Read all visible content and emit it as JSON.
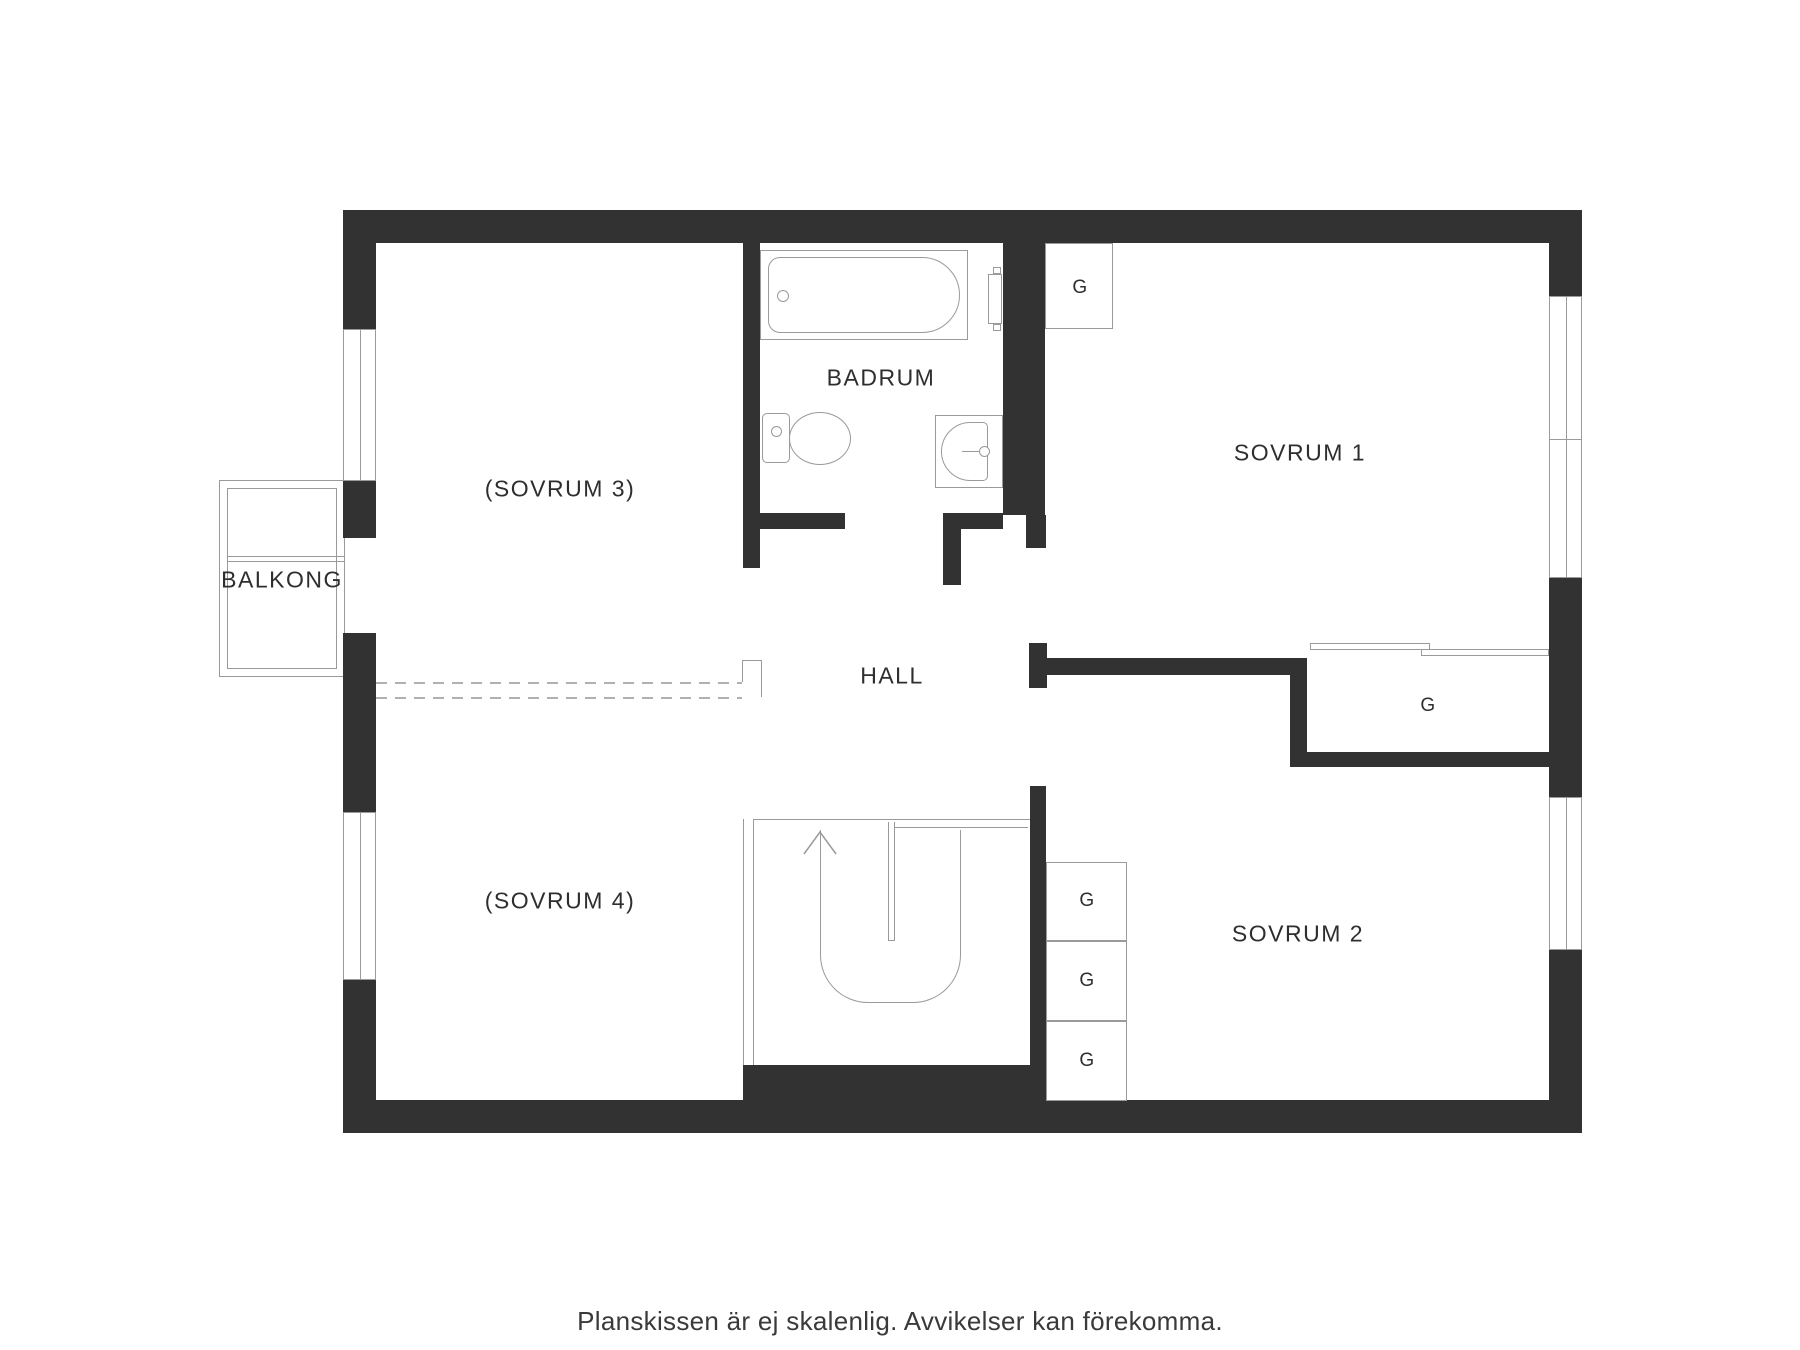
{
  "theme": {
    "wall_color": "#323232",
    "line_color": "#9a9a9a",
    "text_color": "#2e2e2e",
    "background": "#ffffff"
  },
  "rooms": {
    "balcony": {
      "label": "BALKONG"
    },
    "bedroom3": {
      "label": "(SOVRUM 3)"
    },
    "bathroom": {
      "label": "BADRUM"
    },
    "bedroom1": {
      "label": "SOVRUM 1"
    },
    "hall": {
      "label": "HALL"
    },
    "bedroom4": {
      "label": "(SOVRUM 4)"
    },
    "bedroom2": {
      "label": "SOVRUM 2"
    }
  },
  "closets": {
    "bedroom1_corner": "G",
    "bedroom1_wall": "G",
    "bedroom2": [
      "G",
      "G",
      "G"
    ]
  },
  "caption": "Planskissen är ej skalenlig. Avvikelser kan förekomma.",
  "icons": {
    "bathtub": "bathtub-icon",
    "toilet": "toilet-icon",
    "sink": "sink-icon",
    "radiator": "radiator-icon",
    "stairs": "stairs-up-icon",
    "sliding_doors": "sliding-door-icon",
    "removed_wall": "dashed-wall-icon"
  }
}
